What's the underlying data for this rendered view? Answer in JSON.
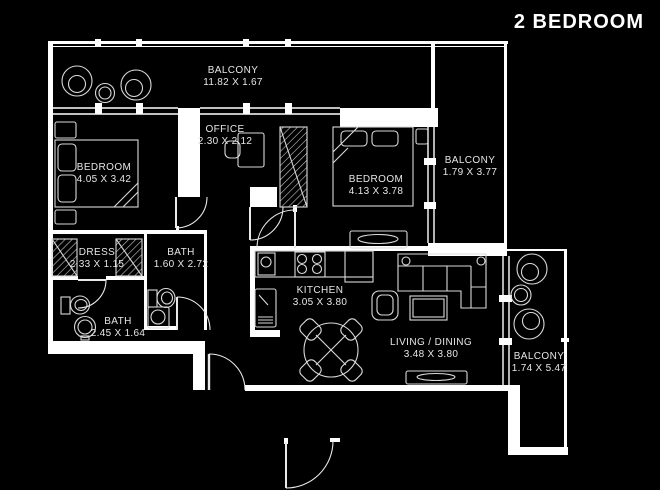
{
  "title": "2 BEDROOM",
  "colors": {
    "background": "#000000",
    "wall_lines": "#ffffff",
    "furniture_lines": "#d9d9d9",
    "label_text": "#e6e6e6"
  },
  "rooms": [
    {
      "id": "balcony-top",
      "name": "BALCONY",
      "dimensions": "11.82 X 1.67"
    },
    {
      "id": "office",
      "name": "OFFICE",
      "dimensions": "2.30 X 2.12"
    },
    {
      "id": "bedroom-1",
      "name": "BEDROOM",
      "dimensions": "4.05 X 3.42"
    },
    {
      "id": "bedroom-2",
      "name": "BEDROOM",
      "dimensions": "4.13 X 3.78"
    },
    {
      "id": "balcony-right",
      "name": "BALCONY",
      "dimensions": "1.79 X 3.77"
    },
    {
      "id": "dress",
      "name": "DRESS",
      "dimensions": "2.33 X 1.15"
    },
    {
      "id": "bath-1",
      "name": "BATH",
      "dimensions": "1.60 X 2.72"
    },
    {
      "id": "bath-2",
      "name": "BATH",
      "dimensions": "2.45 X 1.64"
    },
    {
      "id": "kitchen",
      "name": "KITCHEN",
      "dimensions": "3.05 X 3.80"
    },
    {
      "id": "living-dining",
      "name": "LIVING / DINING",
      "dimensions": "3.48 X 3.80"
    },
    {
      "id": "balcony-bottom",
      "name": "BALCONY",
      "dimensions": "1.74 X 5.47"
    }
  ]
}
